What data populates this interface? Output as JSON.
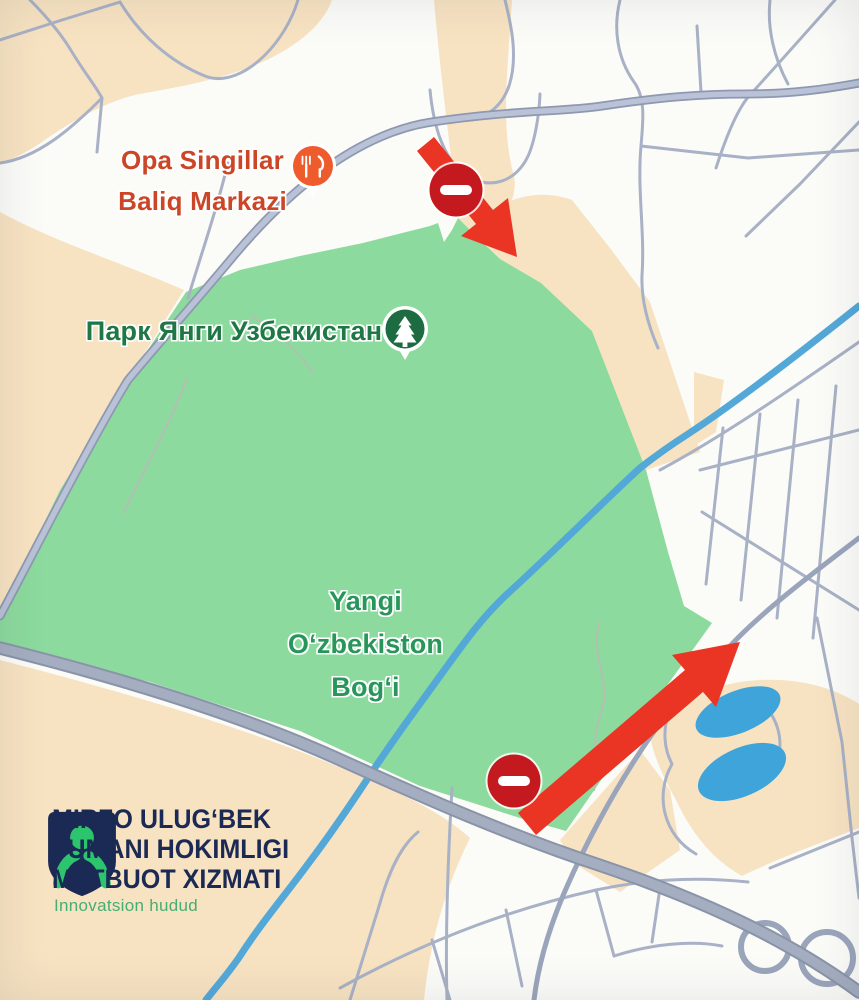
{
  "theme": {
    "base": "#fbfbf8",
    "peach": "#f7e3c2",
    "park-green": "#8cda9d",
    "road": "#a8b1c5",
    "road-medium": "#9aa5bc",
    "main-fill": "#b9c2d6",
    "main-edge": "#8e99b1",
    "highway-fill": "#a4aec0",
    "highway-edge": "#8a94a9",
    "canal": "#54a8d8",
    "pond": "#3fa4d9",
    "arrow-red": "#ea3424",
    "sign-red": "#c4191f",
    "poi-orange": "#ee5b2d",
    "poi-orange-text": "#cb4627",
    "poi-green": "#1d6b41",
    "poi-green-text": "#1e7745",
    "park-label-green": "#28955b",
    "park-path": "#b3bfb2",
    "logo-navy": "#1b2a54",
    "logo-green": "#2dc46e",
    "logo-tagline-green": "#46ad74"
  },
  "map": {
    "poi": {
      "restaurant": {
        "label": "Opa Singillar\nBaliq Markazi",
        "icon": "restaurant-pin"
      },
      "park": {
        "label": "Парк Янги Узбекистан",
        "icon": "park-tree-pin"
      }
    },
    "area_label": "Yangi\nO‘zbekiston\nBog‘i",
    "signs": {
      "north": "no-entry",
      "south": "no-entry"
    },
    "arrows": {
      "north": "southeast",
      "south": "northeast"
    }
  },
  "logo": {
    "org_lines": [
      "MIRZO ULUG‘BEK",
      "TUMANI HOKIMLIGI",
      "MATBUOT XIZMATI"
    ],
    "tagline": "Innovatsion hudud"
  }
}
